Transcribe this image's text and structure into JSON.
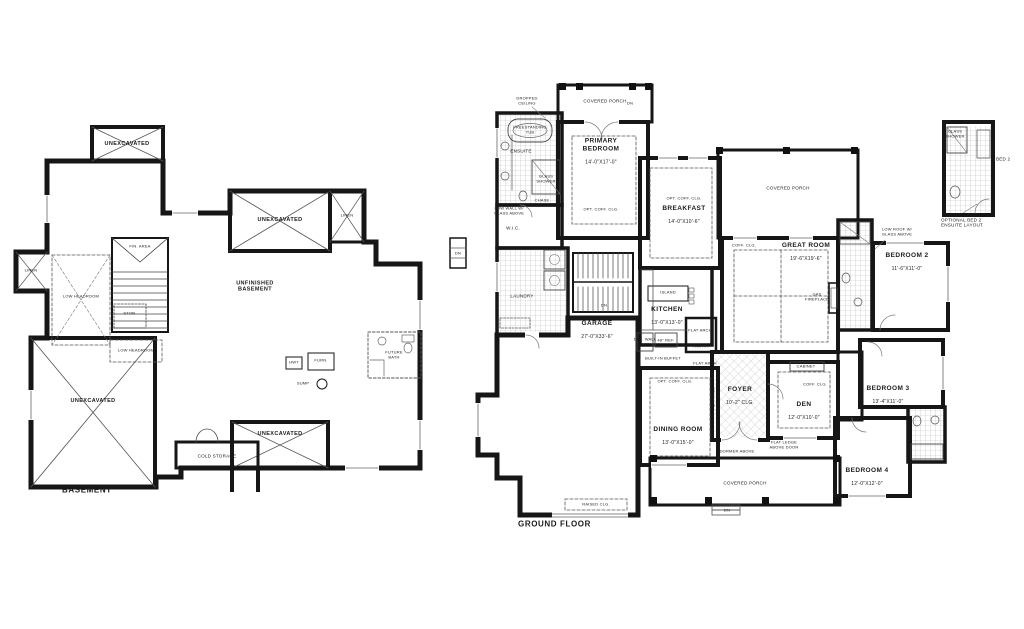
{
  "basement": {
    "caption": "BASEMENT",
    "labels": {
      "unexcavated": "UNEXCAVATED",
      "linen": "LINEN",
      "fin_area": "FIN. AREA",
      "stor": "STOR.",
      "low_headroom": "LOW HEADROOM",
      "unfinished": "UNFINISHED\nBASEMENT",
      "cold_storage": "COLD STORAGE",
      "hwt": "HWT",
      "furn": "FURN.",
      "sump": "SUMP",
      "future_bath": "FUTURE\nBATH"
    }
  },
  "ground": {
    "caption": "GROUND FLOOR",
    "rooms": {
      "covered_porch": "COVERED PORCH",
      "primary": {
        "name": "PRIMARY\nBEDROOM",
        "dims": "14'-0\"X17'-0\""
      },
      "ensuite": "ENSUITE",
      "wic": "W.I.C.",
      "laundry": "LAUNDRY",
      "breakfast": {
        "name": "BREAKFAST",
        "dims": "14'-0\"X10'-6\""
      },
      "great_room": {
        "name": "GREAT ROOM",
        "dims": "19'-6\"X19'-6\""
      },
      "kitchen": {
        "name": "KITCHEN",
        "dims": "13'-0\"X13'-0\""
      },
      "garage": {
        "name": "GARAGE",
        "dims": "27'-0\"X33'-6\""
      },
      "dining": {
        "name": "DINING ROOM",
        "dims": "13'-0\"X15'-0\""
      },
      "foyer": {
        "name": "FOYER",
        "dims": "10'-2\" CLG."
      },
      "den": {
        "name": "DEN",
        "dims": "12'-0\"X10'-0\""
      },
      "bedroom2": {
        "name": "BEDROOM 2",
        "dims": "11'-6\"X11'-0\""
      },
      "bedroom3": {
        "name": "BEDROOM 3",
        "dims": "13'-4\"X11'-0\""
      },
      "bedroom4": {
        "name": "BEDROOM 4",
        "dims": "12'-0\"X12'-0\""
      }
    },
    "notes": {
      "dropped_ceiling": "DROPPED\nCEILING",
      "freestanding_tub": "FREESTANDING\nTUB",
      "glass_shower": "GLASS\nSHOWER",
      "chase": "CHASE",
      "low_wall": "LOW WALL W/\nGLASS ABOVE",
      "low_roof": "LOW ROOF W/\nGLASS ABOVE",
      "opt_coff": "OPT. COFF. CLG.",
      "coff_clg": "COFF. CLG.",
      "flat_arch": "FLAT ARCH",
      "gas_fireplace": "GAS\nFIREPLACE",
      "island": "ISLAND",
      "pantry": "PANTRY",
      "ref48": "48\" REF.",
      "dbl_oven": "DBL. WALL\nOVEN",
      "buffet": "BUILT-IN BUFFET",
      "cabinet": "CABINET",
      "dormer": "DORMER ABOVE",
      "flat_ledge": "FLAT LEDGE\nABOVE DOOR",
      "raised_clg": "RAISED CLG.",
      "dn": "DN"
    },
    "inset": {
      "bed2": "BED 2",
      "caption": "OPTIONAL BED 2\nENSUITE LAYOUT"
    }
  }
}
